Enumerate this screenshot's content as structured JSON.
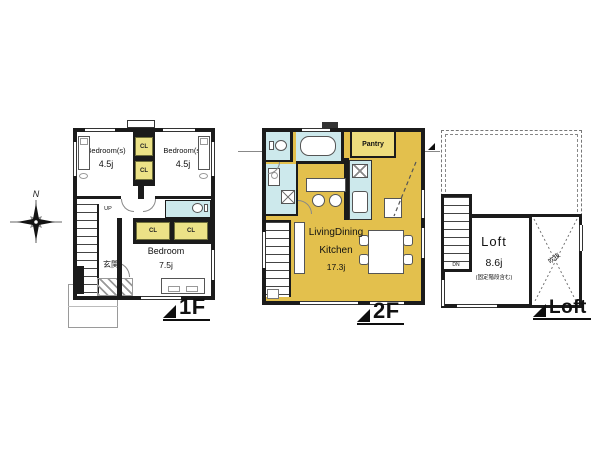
{
  "compass": {
    "north": "N"
  },
  "colors": {
    "wall": "#1b1b1b",
    "closet_yellow": "#ece287",
    "pantry_yellow": "#eedd7d",
    "ldk_yellow": "#e3c04d",
    "wet_area_blue": "#cde9ec"
  },
  "floor1f": {
    "label": "1F",
    "bedroomA_name": "Bedroom(s)",
    "bedroomA_area": "4.5j",
    "bedroomB_name": "Bedroom(s)",
    "bedroomB_area": "4.5j",
    "bedroomC_name": "Bedroom",
    "bedroomC_area": "7.5j",
    "closet": "CL",
    "entrance": "玄関",
    "up": "UP"
  },
  "floor2f": {
    "label": "2F",
    "pantry": "Pantry",
    "ldk_line1": "LivingDining",
    "ldk_line2": "Kitchen",
    "ldk_area": "17.3j"
  },
  "loft": {
    "label": "Loft",
    "name": "Loft",
    "area": "8.6j",
    "note": "(固定階段含む)",
    "void": "吹抜",
    "dn": "DN"
  }
}
